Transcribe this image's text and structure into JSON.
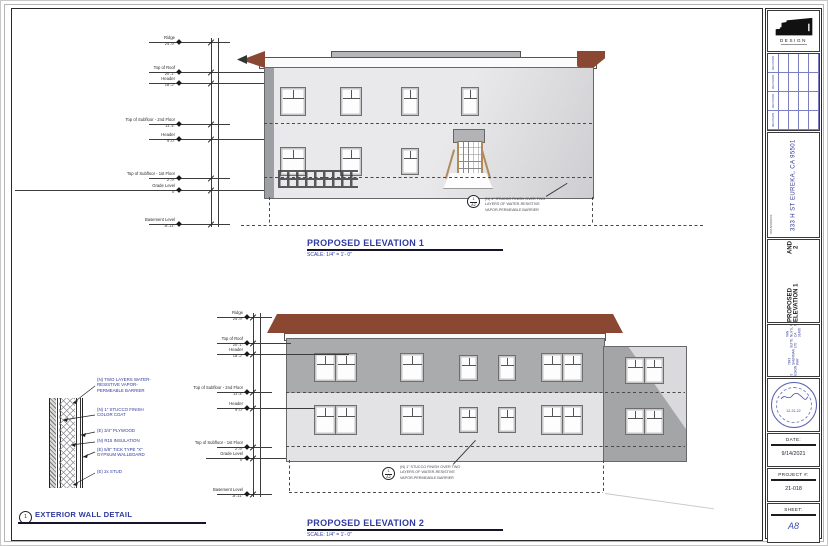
{
  "drawing": {
    "elevation1": {
      "title": "PROPOSED ELEVATION 1",
      "scale": "SCALE: 1/4\" = 1'- 0\""
    },
    "elevation2": {
      "title": "PROPOSED ELEVATION 2",
      "scale": "SCALE: 1/4\" = 1'- 0\""
    },
    "levels": [
      {
        "label": "Ridge",
        "value": "24'-9\""
      },
      {
        "label": "Top of Roof",
        "value": "20'-1\""
      },
      {
        "label": "Header",
        "value": "18'-2\""
      },
      {
        "label": "Top of Subfloor - 2nd Floor",
        "value": "11'-4\""
      },
      {
        "label": "Header",
        "value": "9'-0\""
      },
      {
        "label": "Top of Subfloor - 1st Floor",
        "value": "2'-9\""
      },
      {
        "label": "Grade Level",
        "value": "0'"
      },
      {
        "label": "Basement Level",
        "value": "-8'-11\""
      }
    ],
    "stucco_callout": {
      "ref_detail": "1",
      "ref_sheet": "A2",
      "lines": [
        "(N) 1\" STUCCO FINISH OVER TWO",
        "LAYERS OF WATER-RESISTIVE",
        "VAPOR-PERMEABLE BARRIER"
      ]
    },
    "wall_detail": {
      "number": "1",
      "title": "EXTERIOR WALL DETAIL",
      "notes": [
        [
          "(N) TWO LAYERS WATER-",
          "RESISTIVE VAPOR-",
          "PERMEABLE BARRIER"
        ],
        [
          "(N) 1\" STUCCO FINISH",
          "COLOR COAT"
        ],
        [
          "(E) 3/4\" PLYWOOD"
        ],
        [
          "(N) R15 INSULATION"
        ],
        [
          "(E) 5/8\" TICK TYPE \"X\"",
          "GYPSUM WALLBOARD"
        ],
        [
          "(E) 2x STUD"
        ]
      ]
    }
  },
  "titleblock": {
    "logo_text": "DESIGN",
    "revision_row_label": "REVISION",
    "revision_rows": 4,
    "job_address_label": "JOB ADDRESS:",
    "job_address_line1": "333 H ST",
    "job_address_line2": "EUREKA, CA 95501",
    "sheet_title_line1": "PROPOSED ELEVATION 1",
    "sheet_title_line2": "AND 2",
    "firm_label": "DRAWINGS PROVIDED BY:",
    "firm_lines": [
      "SS DESIGN",
      "7843 SHERMAN WAY",
      "SUITE 170",
      "VAN NUYS, CA 91406",
      "PHONE: 818.592.3201"
    ],
    "stamp_date": "12-31-22",
    "date_label": "DATE:",
    "date_value": "9/14/2021",
    "project_label": "PROJECT #:",
    "project_value": "21-018",
    "sheet_label": "SHEET:",
    "sheet_value": "A8"
  }
}
